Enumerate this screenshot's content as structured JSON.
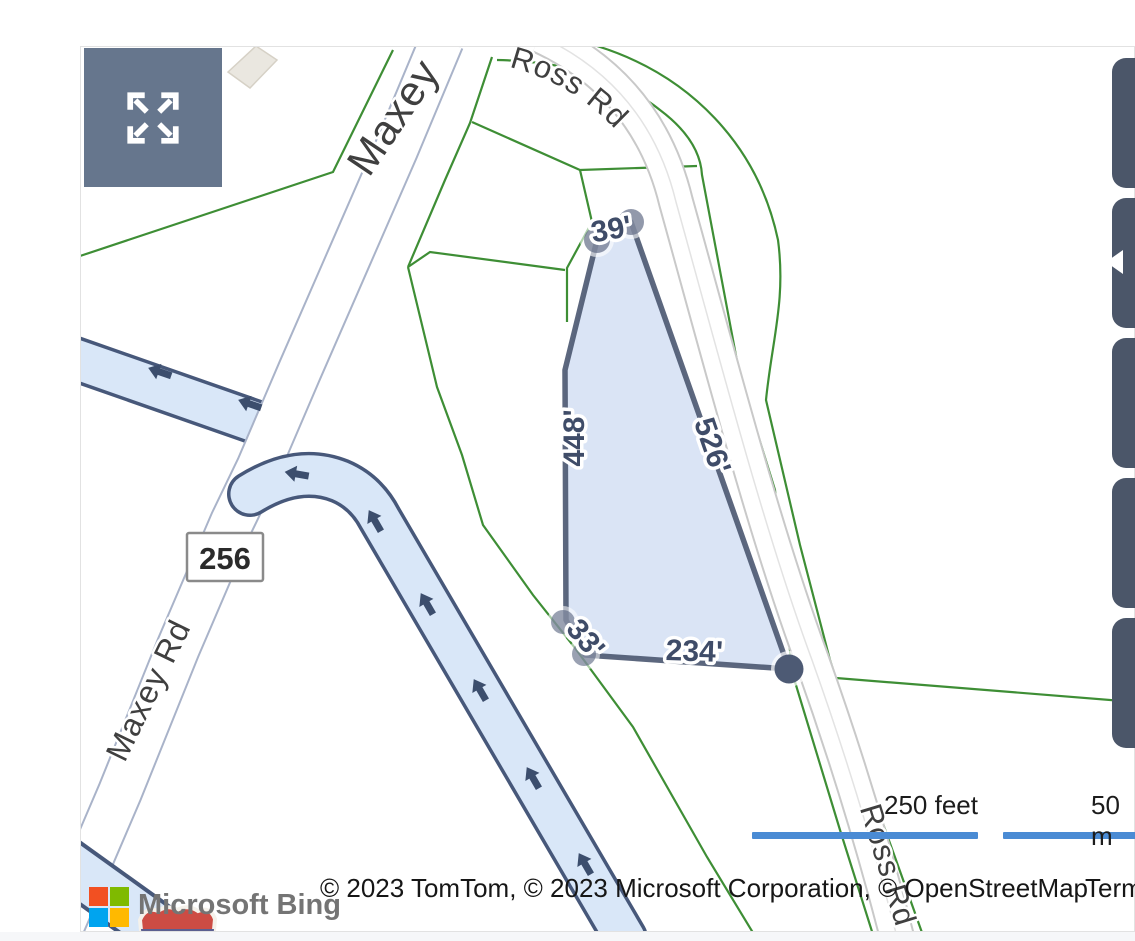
{
  "window": {
    "width": 1135,
    "height": 941,
    "app": "Bing Maps parcel viewer"
  },
  "controls": {
    "expand_button": {
      "icon": "expand-arrows-icon"
    },
    "side_buttons": [
      {
        "id": "side-button-1",
        "icon": ""
      },
      {
        "id": "side-button-2",
        "icon": "collapse-left-icon"
      },
      {
        "id": "side-button-3",
        "icon": ""
      },
      {
        "id": "side-button-4",
        "icon": ""
      },
      {
        "id": "side-button-5",
        "icon": ""
      }
    ]
  },
  "map": {
    "road_labels": {
      "maxey": "Maxey",
      "maxey_rd": "Maxey Rd",
      "ross_rd_top": "Ross Rd",
      "ross_rd_bottom": "Ross Rd"
    },
    "route_shield": "256",
    "parcel": {
      "edge_lengths": {
        "top": "39'",
        "left": "448'",
        "right": "526'",
        "bottom_short": "33'",
        "bottom": "234'"
      }
    },
    "scale_bar": {
      "imperial": "250 feet",
      "metric": "50 m"
    },
    "attribution": "© 2023 TomTom, © 2023 Microsoft Corporation, © OpenStreetMap",
    "terms": "Terms",
    "logo": "Microsoft Bing"
  },
  "colors": {
    "parcel_fill": "#dbe5f6",
    "parcel_border": "#4a5670",
    "highway_fill": "#d9e7f8",
    "highway_casing": "#47587a",
    "boundary_green": "#3e8e35",
    "scale_bar_blue": "#4a8bd4",
    "expand_button_slate": "#66768d",
    "side_button_slate": "#4b5669",
    "maxey_casing": "#a9b3c9",
    "ross_casing": "#c9c9c9",
    "ms_square_red": "#f25022",
    "ms_square_green": "#7fba00",
    "ms_square_blue": "#00a4ef",
    "ms_square_yellow": "#ffb900"
  }
}
